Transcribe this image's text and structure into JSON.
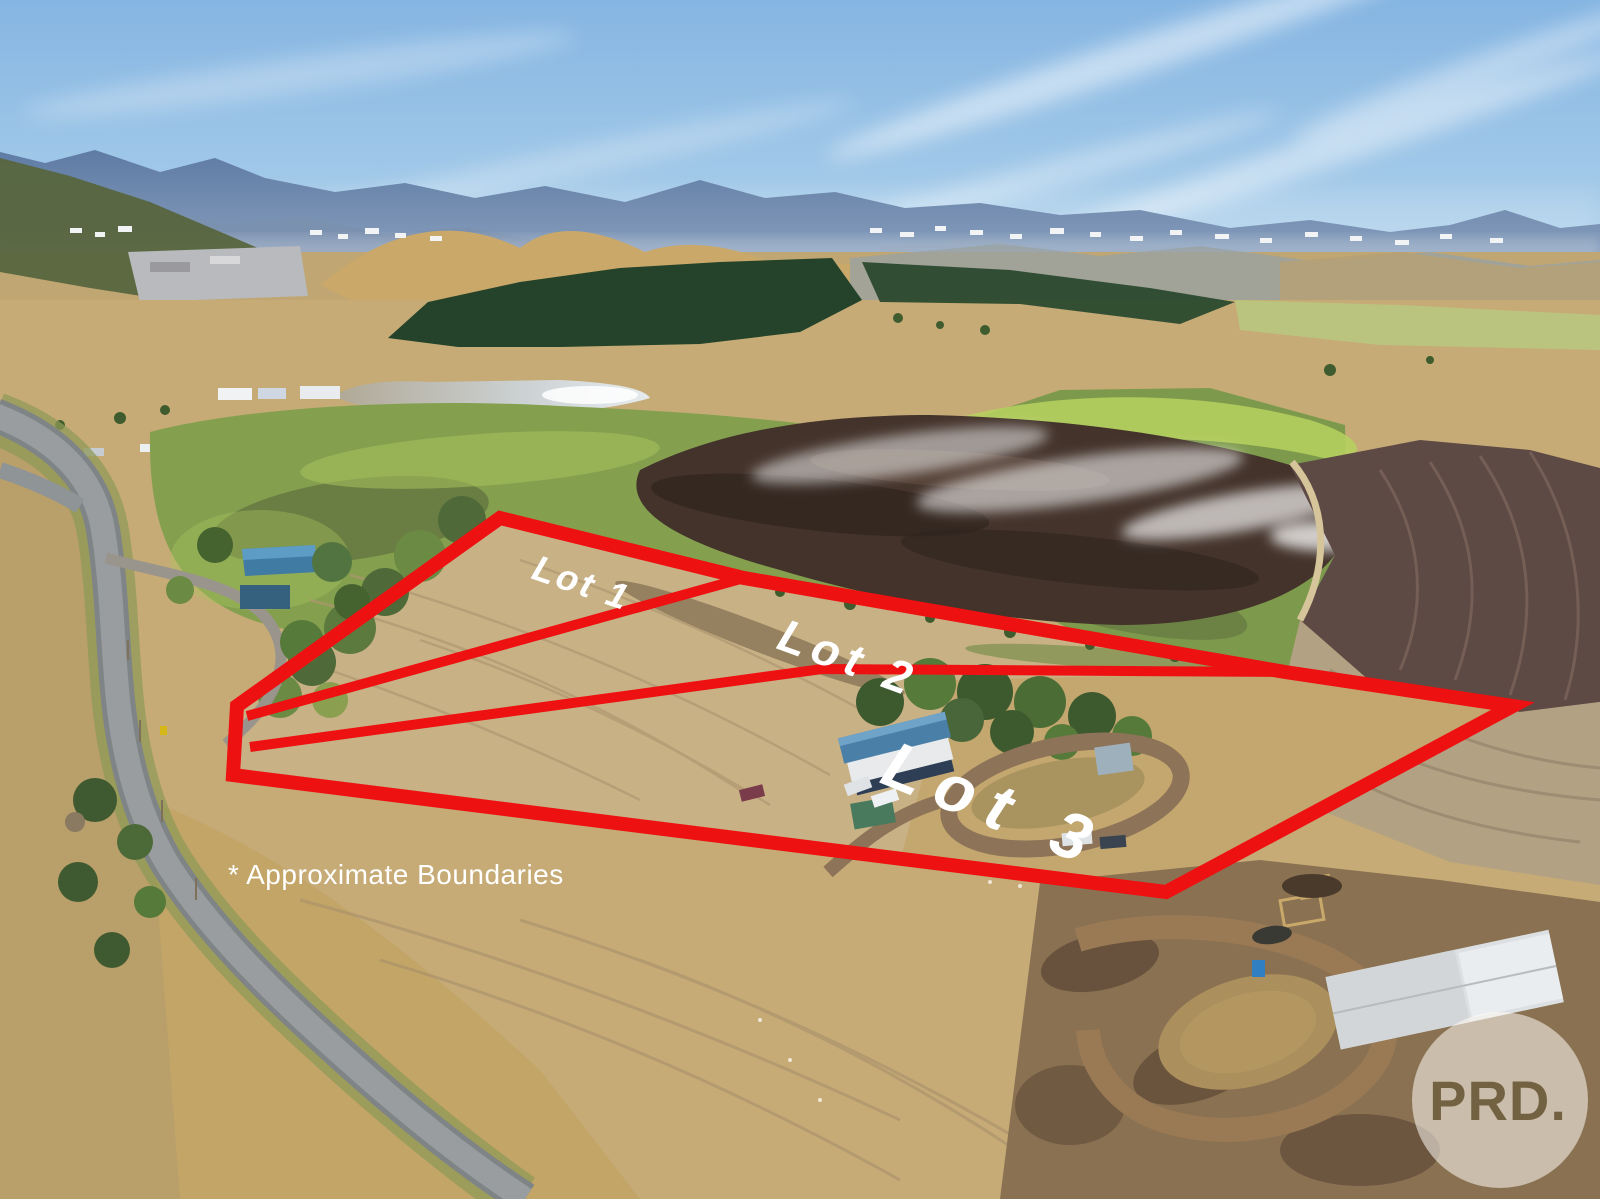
{
  "photo": {
    "scene": "Aerial drone photo of rural acreage with mountains, farmland, dam, plowed fields, country road and homestead",
    "colors": {
      "boundary_red": "#ee1111",
      "label_white": "#ffffff",
      "sky_blue": "#8fbde4",
      "field_tan": "#c9b186",
      "pasture_green": "#84a04f"
    }
  },
  "overlay": {
    "lots": [
      {
        "label": "Lot 1"
      },
      {
        "label": "Lot 2"
      },
      {
        "label": "Lot 3"
      }
    ],
    "disclaimer": "* Approximate Boundaries",
    "watermark": "PRD."
  }
}
